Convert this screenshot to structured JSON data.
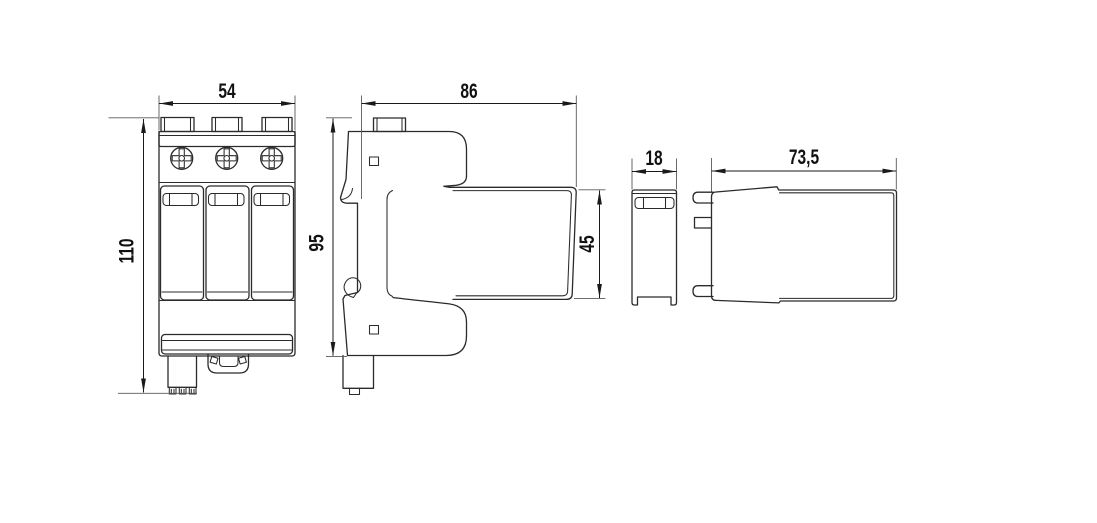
{
  "drawing": {
    "type": "technical-dimension-drawing",
    "background": "#ffffff",
    "object_line_color": "#2b2b2b",
    "dimension_line_color": "#1a1a1a",
    "extension_line_color": "#5a5a5a",
    "text_color": "#111111",
    "views": [
      {
        "id": "front-view",
        "dimensions": [
          "54",
          "110"
        ]
      },
      {
        "id": "side-view",
        "dimensions": [
          "86",
          "95",
          "45"
        ]
      },
      {
        "id": "cartridge-front-view",
        "dimensions": [
          "18"
        ]
      },
      {
        "id": "cartridge-side-view",
        "dimensions": [
          "73,5"
        ]
      }
    ],
    "dimensions": [
      {
        "id": "front-width",
        "label": "54"
      },
      {
        "id": "front-height",
        "label": "110"
      },
      {
        "id": "side-depth",
        "label": "86"
      },
      {
        "id": "side-height",
        "label": "95"
      },
      {
        "id": "cartridge-height",
        "label": "45"
      },
      {
        "id": "cartridge-front-width",
        "label": "18"
      },
      {
        "id": "cartridge-depth",
        "label": "73,5"
      }
    ]
  }
}
